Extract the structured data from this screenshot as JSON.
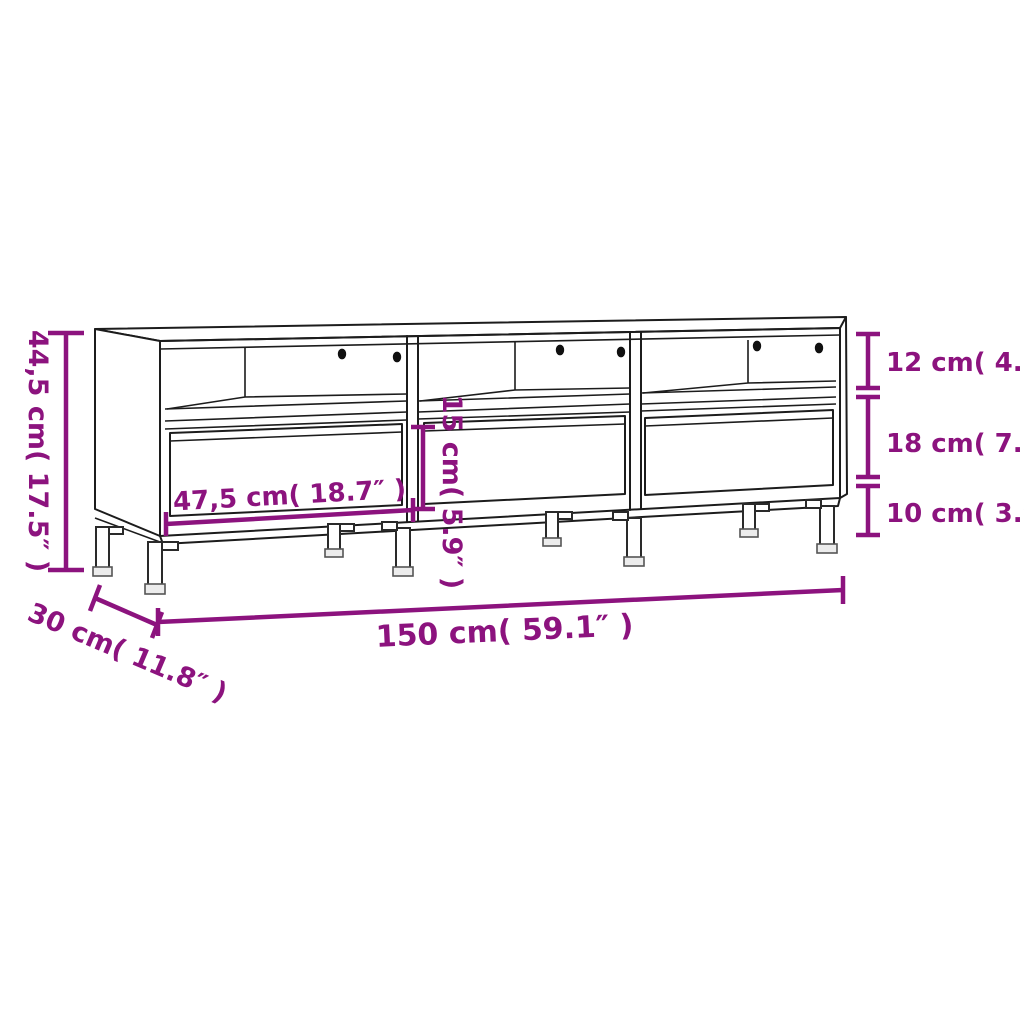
{
  "diagram": {
    "product": "TV cabinet with 3 drawers and 3 open compartments",
    "style": "technical line drawing with dimension annotations"
  },
  "colors": {
    "background": "#ffffff",
    "dimension_accent": "#8C137E",
    "drawing_line": "#1c1c1c"
  },
  "dimensions": {
    "overall_height": {
      "label": "44,5 cm( 17.5″ )",
      "cm": "44,5",
      "inches": "17.5"
    },
    "compartment_height": {
      "label": "12 cm( 4.7″ )",
      "cm": "12",
      "inches": "4.7"
    },
    "drawer_section_height": {
      "label": "18 cm( 7.1″ )",
      "cm": "18",
      "inches": "7.1"
    },
    "leg_height": {
      "label": "10 cm( 3.9″ )",
      "cm": "10",
      "inches": "3.9"
    },
    "drawer_width": {
      "label": "47,5 cm( 18.7″ )",
      "cm": "47,5",
      "inches": "18.7"
    },
    "drawer_front_height": {
      "label": "15 cm( 5.9″ )",
      "cm": "15",
      "inches": "5.9"
    },
    "overall_width": {
      "label": "150 cm( 59.1″ )",
      "cm": "150",
      "inches": "59.1"
    },
    "overall_depth": {
      "label": "30 cm( 11.8″ )",
      "cm": "30",
      "inches": "11.8"
    }
  },
  "features": {
    "sections": 3,
    "drawers": 3,
    "open_compartments": 3,
    "cable_holes_per_compartment": 2,
    "legs_visible": 8
  }
}
